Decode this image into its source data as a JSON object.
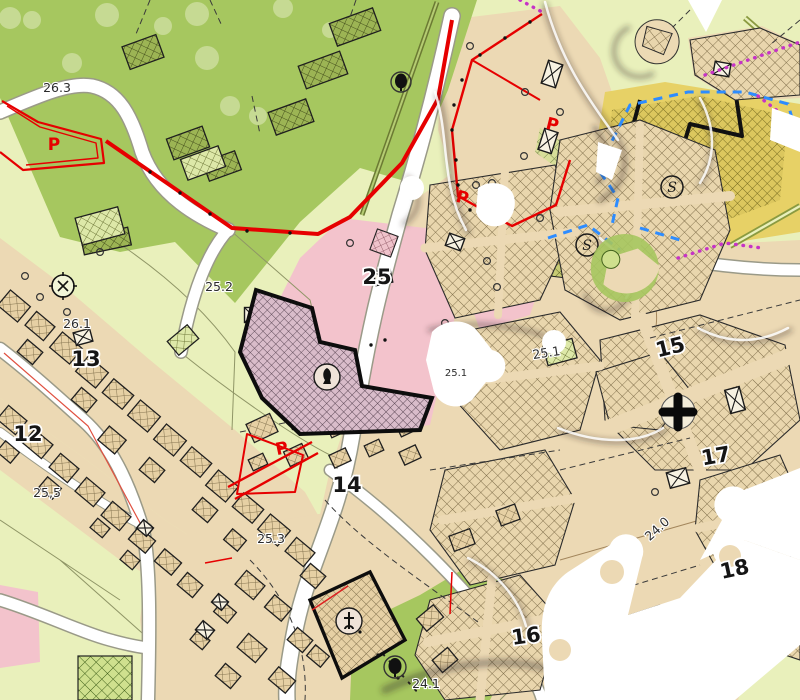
{
  "title": "Cadastral zoning map with jigsaw-puzzle overlay",
  "colors": {
    "green": "#a6c75f",
    "treelight": "#c6da93",
    "pale": "#e9f0bb",
    "tan": "#ecd9b4",
    "pink": "#f3c3cc",
    "yellow": "#e7d166",
    "red": "#e60000",
    "bluedash": "#2d8cff",
    "magenta": "#c633c6",
    "black": "#1a1a1a",
    "white": "#ffffff"
  },
  "labels": {
    "a263": "26.3",
    "a252": "25.2",
    "a261": "26.1",
    "z13": "13",
    "z12": "12",
    "a255": "25,5",
    "z25": "25",
    "a253": "25.3",
    "z14": "14",
    "a251a": "25.1",
    "a251b": "25.1",
    "z15": "15",
    "z17": "17",
    "a240": "24.0",
    "z16": "16",
    "a241": "24.1",
    "z18": "18",
    "p1": "P",
    "p2": "P",
    "p3": "P",
    "p4": "P",
    "s1": "S",
    "s2": "S"
  },
  "symbols": {
    "benchmark": "survey-benchmark circle with x-cross",
    "church": "circled latin cross",
    "chapel_cross": "bold black cross",
    "monument": "circled black poplar tree",
    "tree_dark": "dark filled tree in ring",
    "tree_light": "pale tree canopy blob",
    "xbox": "square parcel symbol with diagonal cross",
    "school": "circled S"
  }
}
